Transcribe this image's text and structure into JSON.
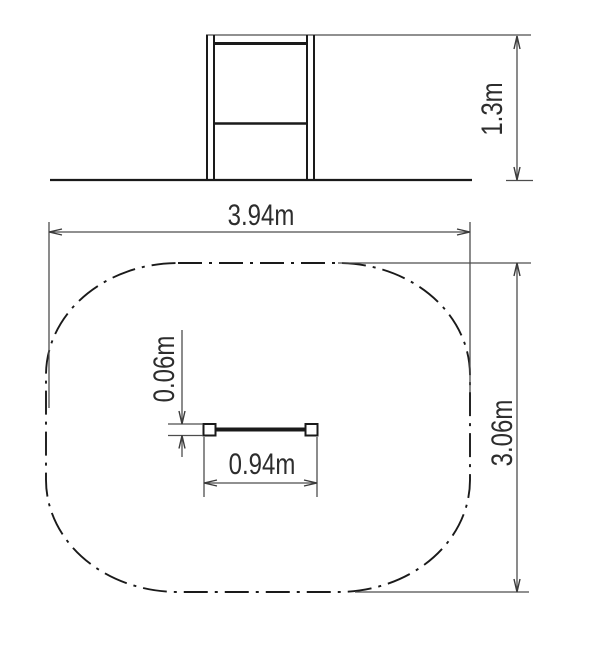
{
  "drawing": {
    "elevation": {
      "height_label": "1.3m"
    },
    "plan": {
      "zone_length_label": "3.94m",
      "zone_width_label": "3.06m",
      "bar_length_label": "0.94m",
      "bar_diameter_label": "0.06m"
    }
  },
  "colors": {
    "object_line": "#1a1a1a",
    "dimension_line": "#4d4d4d",
    "label_text": "#2d2d2d",
    "background": "#ffffff"
  }
}
